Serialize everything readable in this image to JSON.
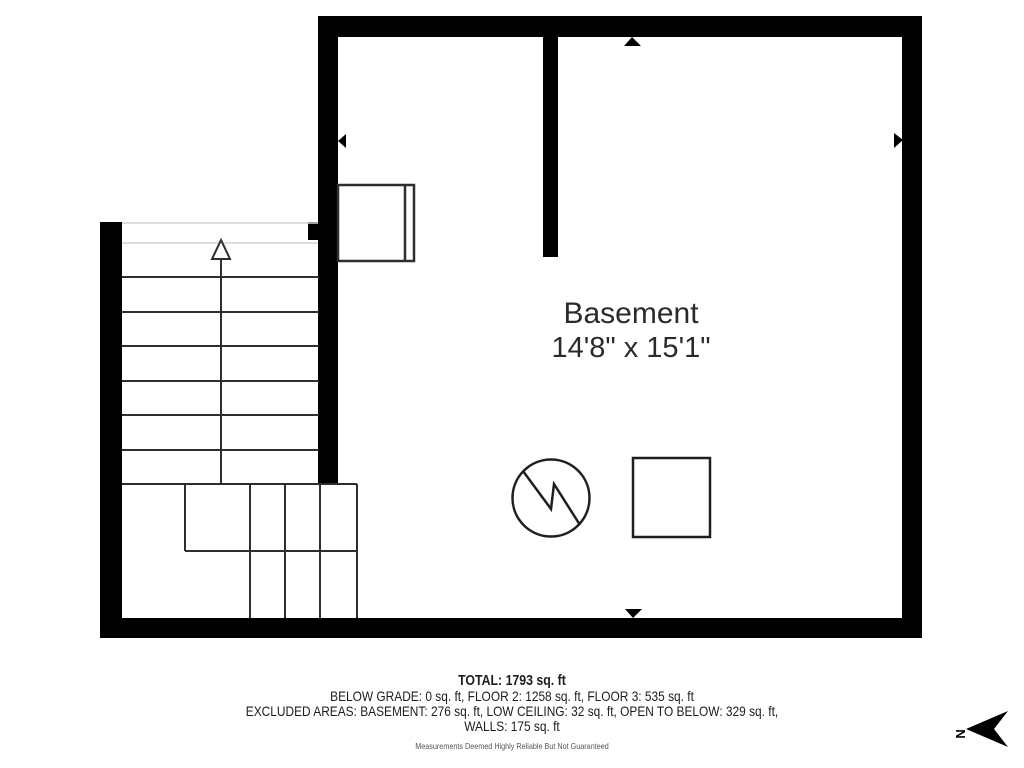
{
  "room": {
    "name": "Basement",
    "dimensions": "14'8\" x 15'1\""
  },
  "summary": {
    "lines": [
      "TOTAL: 1793 sq. ft",
      "BELOW GRADE: 0 sq. ft, FLOOR 2: 1258 sq. ft, FLOOR 3: 535 sq. ft",
      "EXCLUDED AREAS: BASEMENT: 276 sq. ft, LOW CEILING: 32 sq. ft, OPEN TO BELOW: 329 sq. ft,",
      "WALLS: 175 sq. ft"
    ],
    "disclaimer": "Measurements Deemed Highly Reliable But Not Guaranteed"
  },
  "compass": {
    "label": "N",
    "direction": "left"
  },
  "symbols": {
    "water_heater": "circle-with-zigzag",
    "furnace": "square"
  },
  "colors": {
    "wall": "#000000",
    "line": "#2e2e2e",
    "symbol_line": "#1f1f1f",
    "light_line": "#d4d4d4",
    "text": "#2a2a2a",
    "muted_text": "#555555",
    "background": "#ffffff"
  }
}
